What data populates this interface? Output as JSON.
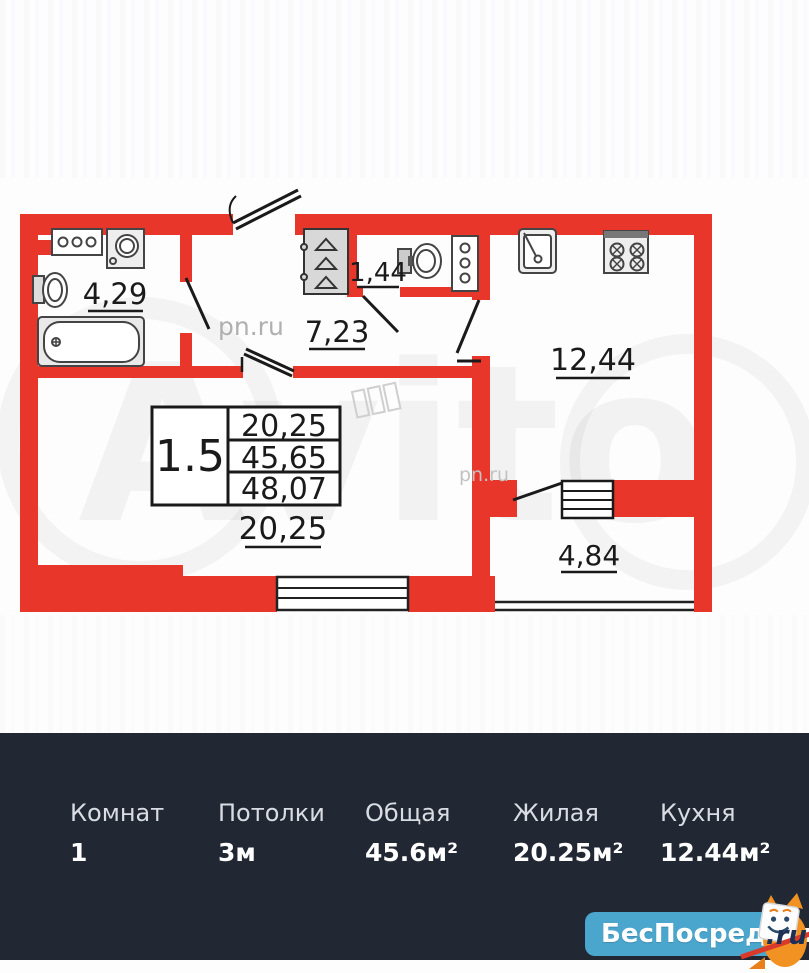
{
  "floorplan": {
    "rooms": {
      "bathroom": "4,29",
      "hallway": "7,23",
      "wc": "1,44",
      "kitchen": "12,44",
      "living": "20,25",
      "balcony": "4,84"
    },
    "info_table": {
      "left": "1.5",
      "rows": [
        "20,25",
        "45,65",
        "48,07"
      ]
    },
    "watermarks": {
      "pn_upper": "pn.ru",
      "pn_lower": "pn.ru",
      "avito": "Avito"
    },
    "colors": {
      "wall": "#e8362a"
    }
  },
  "summary": {
    "background": "#212733",
    "items": [
      {
        "label": "Комнат",
        "value": "1"
      },
      {
        "label": "Потолки",
        "value": "3м"
      },
      {
        "label": "Общая",
        "value": "45.6м²"
      },
      {
        "label": "Жилая",
        "value": "20.25м²"
      },
      {
        "label": "Кухня",
        "value": "12.44м²"
      }
    ]
  },
  "brand": {
    "name": "БесПосредника",
    "tld": ".ru",
    "blue": "#4ba6cd"
  }
}
